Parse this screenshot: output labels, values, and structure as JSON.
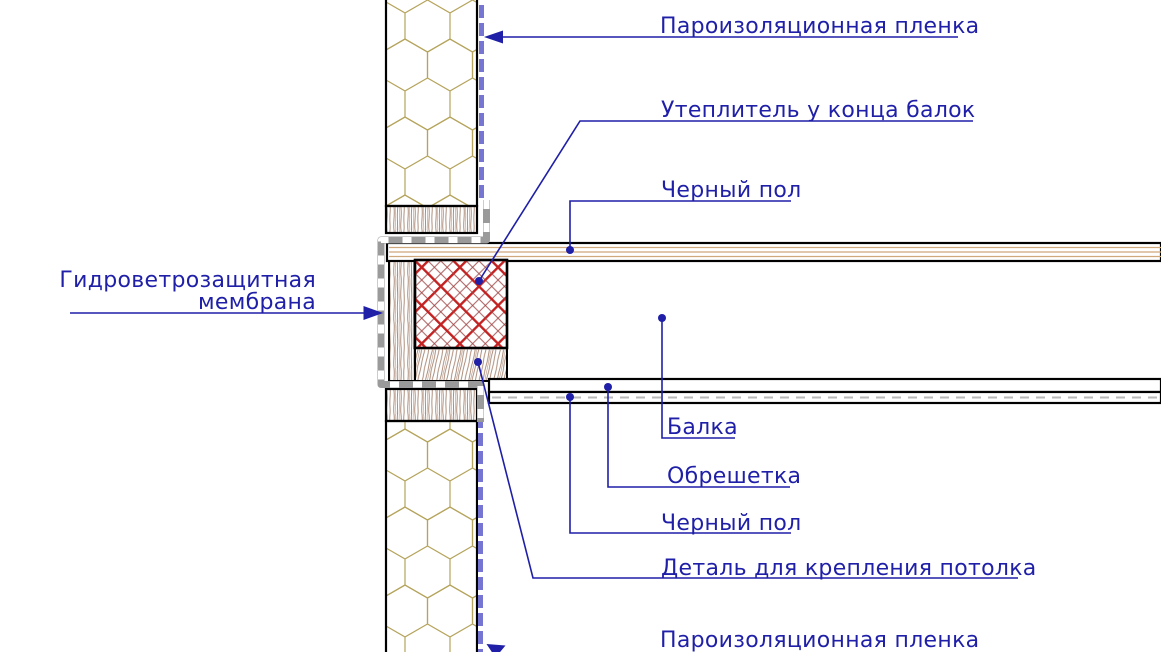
{
  "drawing": {
    "title": "Узел примыкания перекрытия к каркасной стене",
    "labels": {
      "vapor_film_top": "Пароизоляционная пленка",
      "insulation_beam_end": "Утеплитель у конца балок",
      "subfloor_top": "Черный пол",
      "wind_membrane_line1": "Гидроветрозащитная",
      "wind_membrane_line2": "мембрана",
      "beam": "Балка",
      "lathing": "Обрешетка",
      "subfloor_bottom": "Черный пол",
      "ceiling_fixing_detail": "Деталь для крепления потолка",
      "vapor_film_bottom": "Пароизоляционная пленка"
    },
    "colors": {
      "annotation_blue": "#1f1fa8",
      "vapor_barrier_blue": "#7676d2",
      "membrane_gray": "#9a9a9a",
      "insulation_hatch": "#b5a45c",
      "wood_grain": "#a5826e",
      "red_hatch_fine": "#a04848",
      "red_hatch_bold": "#c22222",
      "deck_line_tan": "#cfa87b",
      "ceiling_dash_gray": "#b9b9b9",
      "outline_black": "#000000"
    }
  }
}
